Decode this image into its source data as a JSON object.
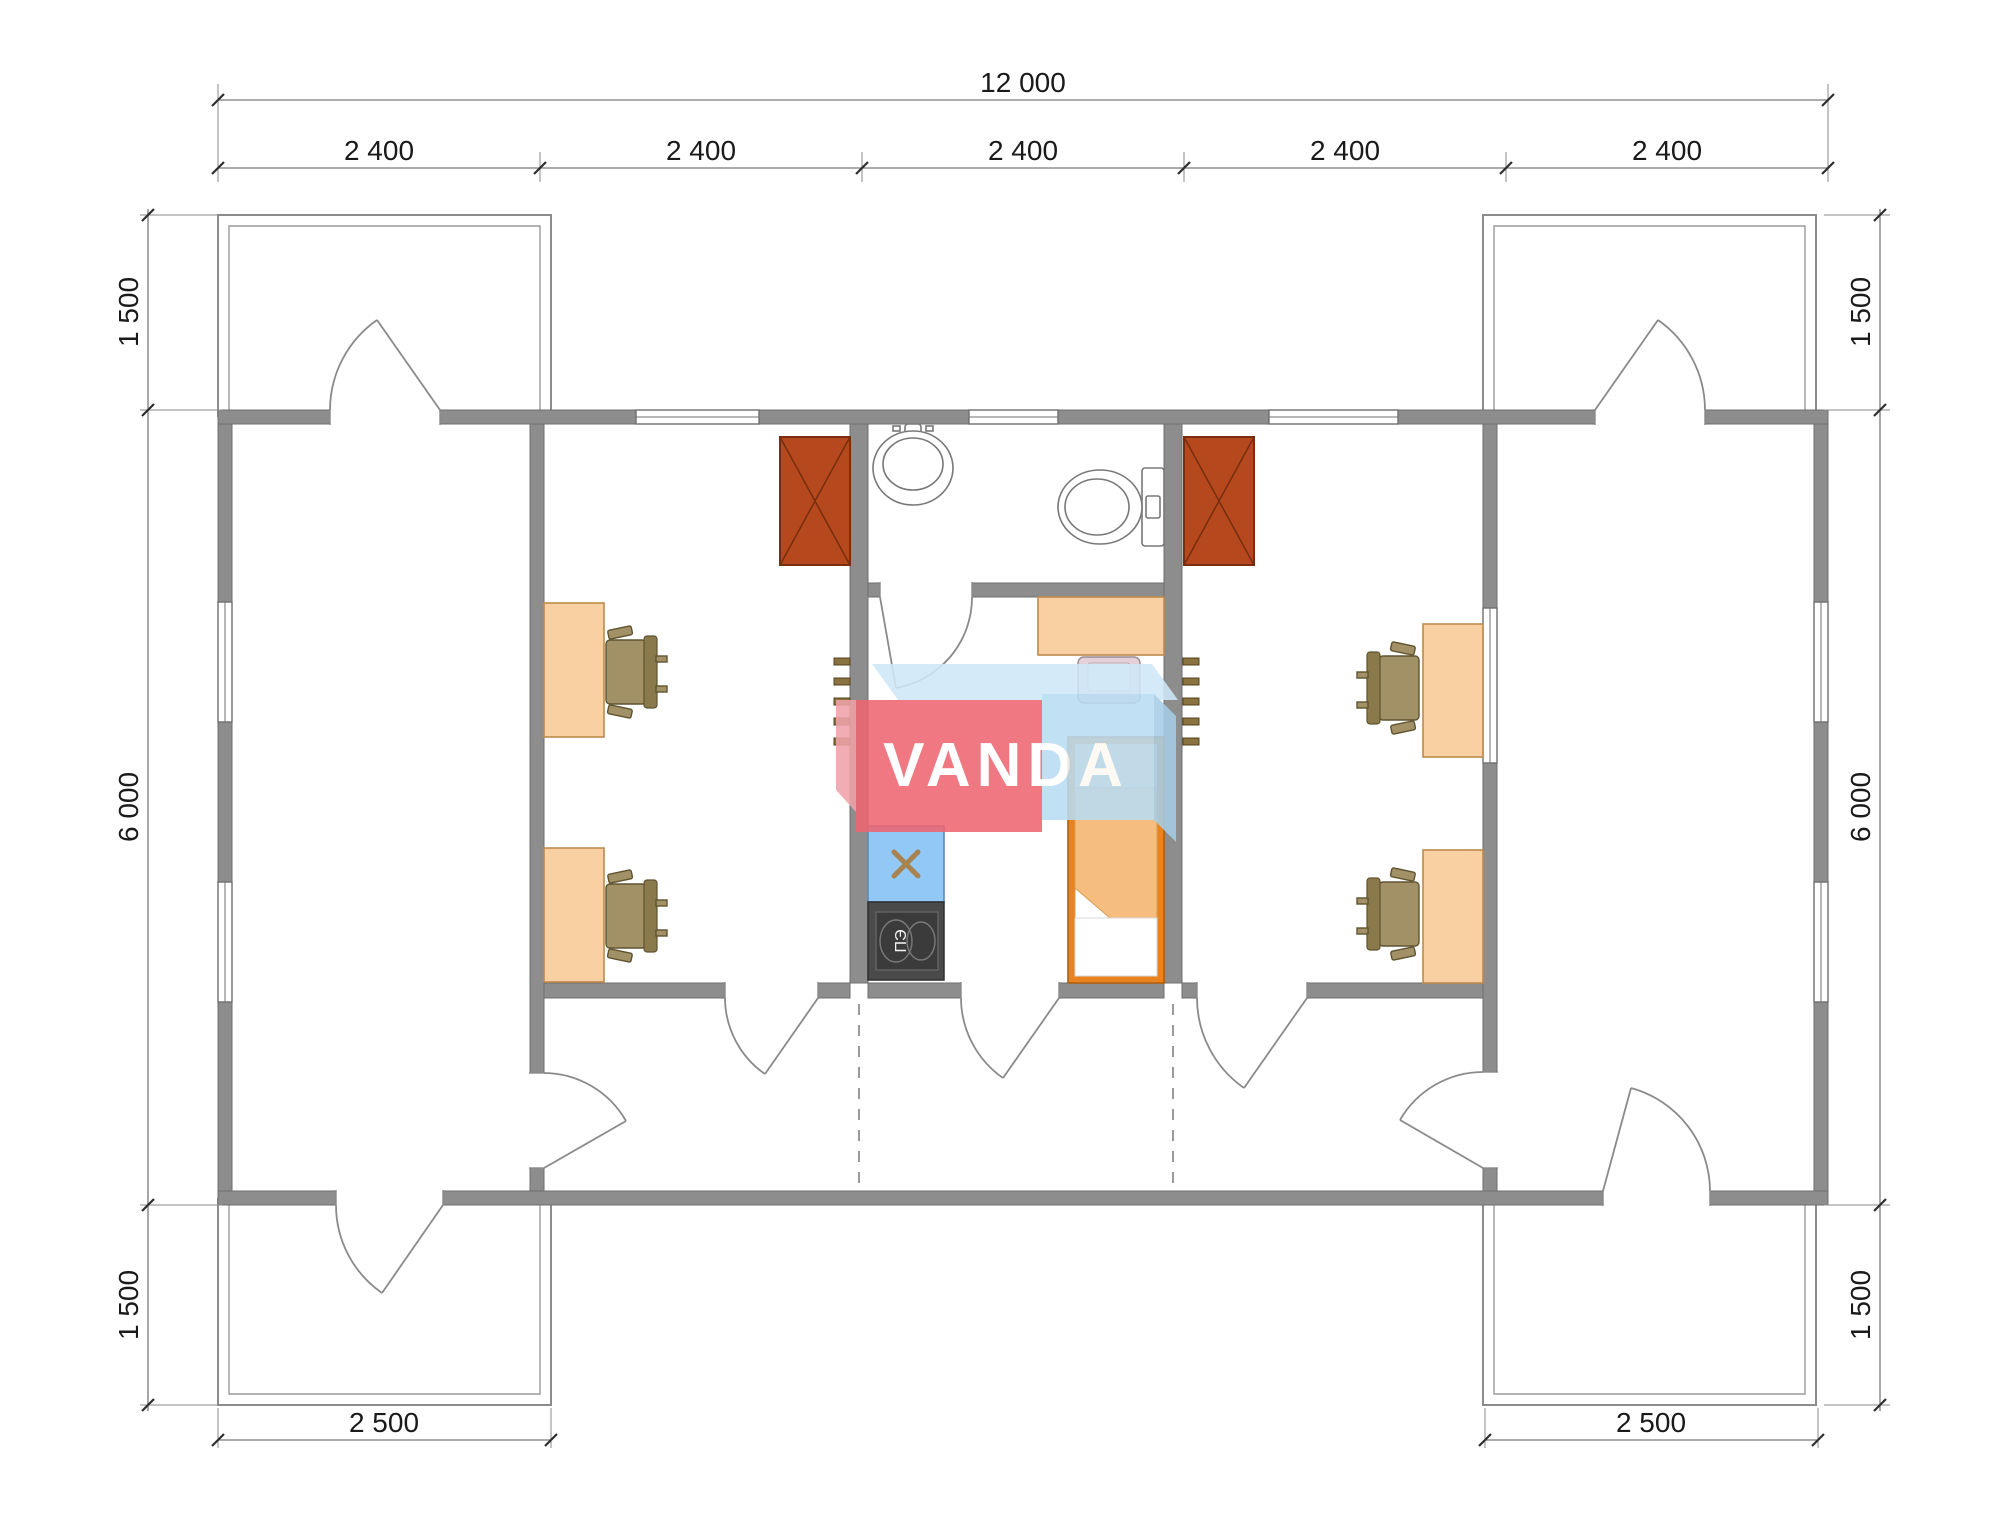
{
  "drawing": {
    "logo": {
      "text": "VANDA",
      "pink": "#ed6671",
      "blue": "#b9dcf3",
      "bevel": "#cfe8f8"
    },
    "stove_label": "ПЭ",
    "dims": {
      "top_total": "12 000",
      "top_segments": [
        "2 400",
        "2 400",
        "2 400",
        "2 400",
        "2 400"
      ],
      "left": [
        "1 500",
        "6 000",
        "1 500"
      ],
      "right": [
        "1 500",
        "6 000",
        "1 500"
      ],
      "bottom": [
        "2 500",
        "2 500"
      ]
    },
    "colors": {
      "wall": "#8d8d8d",
      "wardrobe": "#b5491d",
      "desk": "#f9d0a1",
      "chair": "#a29167",
      "bed_frame": "#e8831f",
      "bed_blanket": "#f5bd7e",
      "counter_blue": "#92c8f5",
      "stove": "#4a4a4a"
    }
  }
}
